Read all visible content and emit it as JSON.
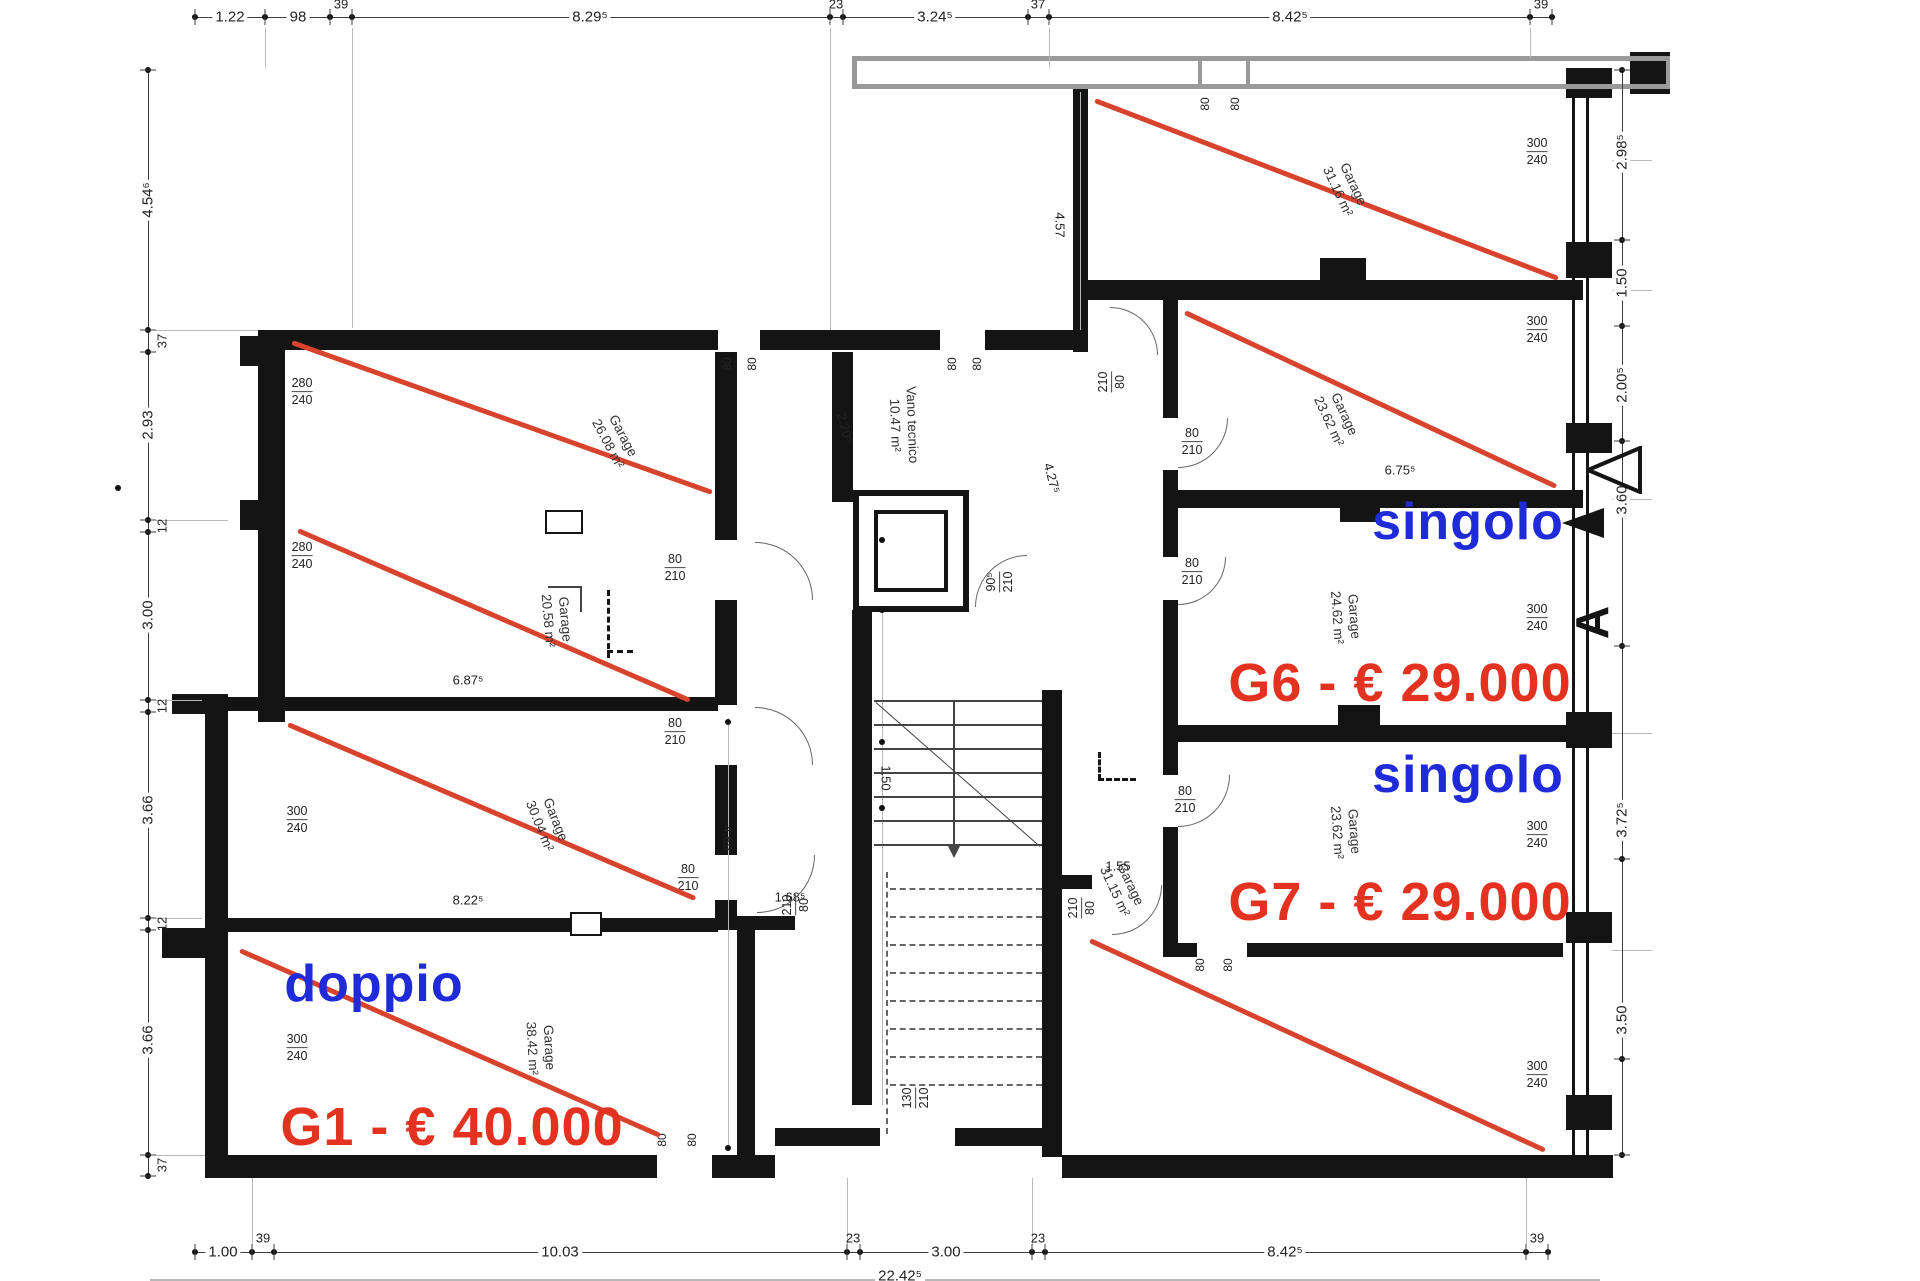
{
  "drawing": {
    "type": "architectural floor plan - garage level with prices",
    "section_letter": "A",
    "palette": {
      "wall": "#141414",
      "gray_wall": "#9a9a9a",
      "red_line": "#d8432d",
      "blue_text": "#1f2bd8",
      "red_text": "#e33220",
      "dim_text": "#222222"
    },
    "sale_labels": [
      {
        "text": "doppio",
        "x": 374,
        "y": 984,
        "color": "#1f2bd8",
        "size": 52
      },
      {
        "text": "G1 - € 40.000",
        "x": 452,
        "y": 1127,
        "color": "#e33220",
        "size": 54
      },
      {
        "text": "singolo",
        "x": 1468,
        "y": 522,
        "color": "#1f2bd8",
        "size": 52
      },
      {
        "text": "G6 - € 29.000",
        "x": 1400,
        "y": 683,
        "color": "#e33220",
        "size": 54
      },
      {
        "text": "singolo",
        "x": 1468,
        "y": 775,
        "color": "#1f2bd8",
        "size": 52
      },
      {
        "text": "G7 - € 29.000",
        "x": 1400,
        "y": 902,
        "color": "#e33220",
        "size": 54
      }
    ],
    "rooms": [
      {
        "name": "Garage",
        "area": "26.08 m²",
        "x": 615,
        "y": 440,
        "rot": 62
      },
      {
        "name": "Garage",
        "area": "20.58 m²",
        "x": 556,
        "y": 620,
        "rot": 85
      },
      {
        "name": "Garage",
        "area": "30.04 m²",
        "x": 547,
        "y": 823,
        "rot": 68
      },
      {
        "name": "Garage",
        "area": "38.42 m²",
        "x": 540,
        "y": 1048,
        "rot": 87
      },
      {
        "name": "Vano tecnico",
        "area": "10.47 m²",
        "x": 903,
        "y": 425,
        "rot": 88
      },
      {
        "name": "Garage",
        "area": "31.16 m²",
        "x": 1345,
        "y": 188,
        "rot": 65
      },
      {
        "name": "Garage",
        "area": "23.62 m²",
        "x": 1336,
        "y": 418,
        "rot": 65
      },
      {
        "name": "Garage",
        "area": "24.62 m²",
        "x": 1345,
        "y": 617,
        "rot": 86
      },
      {
        "name": "Garage",
        "area": "23.62 m²",
        "x": 1345,
        "y": 832,
        "rot": 86
      },
      {
        "name": "Garage",
        "area": "31.15 m²",
        "x": 1122,
        "y": 888,
        "rot": 65
      }
    ],
    "chains": {
      "top": {
        "line": [
          195,
          17,
          1357,
          0
        ],
        "ticks_x": [
          195,
          265,
          330,
          352,
          830,
          843,
          1028,
          1049,
          1530,
          1552
        ],
        "labels": [
          {
            "t": "1.22",
            "x": 230,
            "y": 17
          },
          {
            "t": "98",
            "x": 298,
            "y": 17
          },
          {
            "t": "39",
            "x": 341,
            "y": 4,
            "off": true
          },
          {
            "t": "8.29⁵",
            "x": 590,
            "y": 17
          },
          {
            "t": "23",
            "x": 836,
            "y": 4,
            "off": true
          },
          {
            "t": "3.24⁵",
            "x": 935,
            "y": 17
          },
          {
            "t": "37",
            "x": 1038,
            "y": 4,
            "off": true
          },
          {
            "t": "8.42⁵",
            "x": 1290,
            "y": 17
          },
          {
            "t": "39",
            "x": 1541,
            "y": 4,
            "off": true
          }
        ]
      },
      "bottom": {
        "line": [
          195,
          1252,
          1353,
          0
        ],
        "ticks_x": [
          195,
          252,
          274,
          847,
          860,
          1032,
          1045,
          1526,
          1548
        ],
        "labels": [
          {
            "t": "1.00",
            "x": 223,
            "y": 1252
          },
          {
            "t": "39",
            "x": 263,
            "y": 1238,
            "off": true
          },
          {
            "t": "10.03",
            "x": 560,
            "y": 1252
          },
          {
            "t": "23",
            "x": 853,
            "y": 1238,
            "off": true
          },
          {
            "t": "3.00",
            "x": 946,
            "y": 1252
          },
          {
            "t": "23",
            "x": 1038,
            "y": 1238,
            "off": true
          },
          {
            "t": "8.42⁵",
            "x": 1285,
            "y": 1252
          },
          {
            "t": "39",
            "x": 1537,
            "y": 1238,
            "off": true
          },
          {
            "t": "22.42⁵",
            "x": 900,
            "y": 1276
          }
        ]
      },
      "left": {
        "line": [
          148,
          70,
          0,
          1106
        ],
        "ticks_y": [
          70,
          330,
          352,
          520,
          532,
          700,
          712,
          918,
          930,
          1155,
          1176
        ],
        "labels": [
          {
            "t": "4.54⁶",
            "x": 148,
            "y": 200
          },
          {
            "t": "37",
            "x": 162,
            "y": 341,
            "off": true
          },
          {
            "t": "2.93",
            "x": 148,
            "y": 425
          },
          {
            "t": "12",
            "x": 162,
            "y": 526,
            "off": true
          },
          {
            "t": "3.00",
            "x": 148,
            "y": 615
          },
          {
            "t": "12",
            "x": 162,
            "y": 706,
            "off": true
          },
          {
            "t": "3.66",
            "x": 148,
            "y": 810
          },
          {
            "t": "12",
            "x": 162,
            "y": 924,
            "off": true
          },
          {
            "t": "3.66",
            "x": 148,
            "y": 1040
          },
          {
            "t": "37",
            "x": 162,
            "y": 1165,
            "off": true
          }
        ]
      },
      "right": {
        "line": [
          1622,
          70,
          0,
          1085
        ],
        "ticks_y": [
          70,
          240,
          326,
          441,
          646,
          859,
          1059,
          1155
        ],
        "labels": [
          {
            "t": "2.98⁵",
            "x": 1622,
            "y": 152
          },
          {
            "t": "1.50",
            "x": 1622,
            "y": 283
          },
          {
            "t": "2.00⁵",
            "x": 1622,
            "y": 385
          },
          {
            "t": "3.60",
            "x": 1622,
            "y": 500
          },
          {
            "t": "3.72⁵",
            "x": 1622,
            "y": 820
          },
          {
            "t": "3.50",
            "x": 1622,
            "y": 1020
          }
        ]
      }
    },
    "dims_plain": [
      {
        "t": "6.87⁵",
        "x": 468,
        "y": 680
      },
      {
        "t": "8.22⁵",
        "x": 468,
        "y": 900
      },
      {
        "t": "1.68⁵",
        "x": 790,
        "y": 897
      },
      {
        "t": "1.55",
        "x": 1118,
        "y": 866
      },
      {
        "t": "6.75⁵",
        "x": 1400,
        "y": 470
      }
    ],
    "dims_rot": [
      {
        "t": "2.20⁵",
        "x": 845,
        "y": 428,
        "rot": 75
      },
      {
        "t": "4.27⁵",
        "x": 1052,
        "y": 478,
        "rot": 75
      },
      {
        "t": "4.57",
        "x": 1060,
        "y": 225,
        "rot": 90
      },
      {
        "t": "4.69",
        "x": 728,
        "y": 838,
        "rot": 90
      },
      {
        "t": "1.50",
        "x": 886,
        "y": 570,
        "rot": 90
      },
      {
        "t": "1.50",
        "x": 886,
        "y": 778,
        "rot": 90
      }
    ],
    "door_fracs": [
      {
        "top": "80",
        "bot": "210",
        "x": 675,
        "y": 568
      },
      {
        "top": "80",
        "bot": "210",
        "x": 675,
        "y": 732
      },
      {
        "top": "80",
        "bot": "210",
        "x": 688,
        "y": 878
      },
      {
        "top": "80",
        "bot": "210",
        "x": 1192,
        "y": 442
      },
      {
        "top": "80",
        "bot": "210",
        "x": 1192,
        "y": 572
      },
      {
        "top": "80",
        "bot": "210",
        "x": 1185,
        "y": 800
      }
    ],
    "door_fracs_rot": [
      {
        "top": "210",
        "bot": "80",
        "x": 796,
        "y": 905
      },
      {
        "top": "90⁵",
        "bot": "210",
        "x": 1000,
        "y": 582
      },
      {
        "top": "210",
        "bot": "80",
        "x": 1112,
        "y": 382
      },
      {
        "top": "210",
        "bot": "80",
        "x": 1082,
        "y": 908
      },
      {
        "top": "130",
        "bot": "210",
        "x": 916,
        "y": 1098
      }
    ],
    "garage_door_fracs": [
      {
        "top": "280",
        "bot": "240",
        "x": 302,
        "y": 392
      },
      {
        "top": "280",
        "bot": "240",
        "x": 302,
        "y": 556
      },
      {
        "top": "300",
        "bot": "240",
        "x": 297,
        "y": 820
      },
      {
        "top": "300",
        "bot": "240",
        "x": 297,
        "y": 1048
      },
      {
        "top": "300",
        "bot": "240",
        "x": 1537,
        "y": 152
      },
      {
        "top": "300",
        "bot": "240",
        "x": 1537,
        "y": 330
      },
      {
        "top": "300",
        "bot": "240",
        "x": 1537,
        "y": 618
      },
      {
        "top": "300",
        "bot": "240",
        "x": 1537,
        "y": 835
      },
      {
        "top": "300",
        "bot": "240",
        "x": 1537,
        "y": 1075
      }
    ],
    "opening_labels": [
      {
        "t": "80",
        "x": 727,
        "y": 364
      },
      {
        "t": "80",
        "x": 752,
        "y": 364
      },
      {
        "t": "80",
        "x": 952,
        "y": 364
      },
      {
        "t": "80",
        "x": 977,
        "y": 364
      },
      {
        "t": "80",
        "x": 662,
        "y": 1140
      },
      {
        "t": "80",
        "x": 692,
        "y": 1140
      },
      {
        "t": "80",
        "x": 1200,
        "y": 965
      },
      {
        "t": "80",
        "x": 1228,
        "y": 965
      },
      {
        "t": "80",
        "x": 1205,
        "y": 104
      },
      {
        "t": "80",
        "x": 1235,
        "y": 104
      }
    ],
    "red_lines": [
      [
        292,
        342,
        712,
        492
      ],
      [
        298,
        530,
        690,
        700
      ],
      [
        288,
        724,
        695,
        898
      ],
      [
        240,
        950,
        660,
        1135
      ],
      [
        1095,
        100,
        1558,
        278
      ],
      [
        1185,
        312,
        1556,
        486
      ],
      [
        1090,
        940,
        1545,
        1150
      ]
    ],
    "walls": [
      [
        258,
        330,
        460,
        20
      ],
      [
        760,
        330,
        180,
        20
      ],
      [
        985,
        330,
        103,
        20
      ],
      [
        258,
        330,
        27,
        392
      ],
      [
        240,
        336,
        18,
        30
      ],
      [
        240,
        500,
        18,
        30
      ],
      [
        172,
        694,
        56,
        20
      ],
      [
        228,
        697,
        490,
        14
      ],
      [
        205,
        714,
        23,
        443
      ],
      [
        162,
        928,
        66,
        30
      ],
      [
        228,
        918,
        490,
        14
      ],
      [
        205,
        1155,
        452,
        23
      ],
      [
        712,
        1155,
        63,
        23
      ],
      [
        715,
        352,
        22,
        188
      ],
      [
        715,
        600,
        22,
        105
      ],
      [
        715,
        765,
        22,
        90
      ],
      [
        715,
        900,
        22,
        30
      ],
      [
        737,
        916,
        58,
        14
      ],
      [
        737,
        930,
        18,
        228
      ],
      [
        775,
        1128,
        105,
        18
      ],
      [
        955,
        1128,
        107,
        18
      ],
      [
        832,
        352,
        21,
        150
      ],
      [
        852,
        610,
        20,
        95
      ],
      [
        852,
        700,
        20,
        405
      ],
      [
        1042,
        690,
        20,
        467
      ],
      [
        1062,
        875,
        30,
        14
      ],
      [
        1073,
        88,
        15,
        264
      ],
      [
        1163,
        300,
        15,
        118
      ],
      [
        1163,
        470,
        15,
        87
      ],
      [
        1163,
        600,
        15,
        175
      ],
      [
        1163,
        827,
        15,
        130
      ],
      [
        1088,
        280,
        495,
        20
      ],
      [
        1320,
        258,
        46,
        22
      ],
      [
        1178,
        490,
        405,
        18
      ],
      [
        1340,
        508,
        40,
        14
      ],
      [
        1178,
        725,
        405,
        17
      ],
      [
        1338,
        705,
        42,
        20
      ],
      [
        1167,
        943,
        30,
        14
      ],
      [
        1247,
        943,
        316,
        14
      ],
      [
        1062,
        1155,
        521,
        23
      ],
      [
        1566,
        68,
        46,
        30
      ],
      [
        1566,
        242,
        46,
        36
      ],
      [
        1566,
        423,
        46,
        30
      ],
      [
        1566,
        712,
        46,
        36
      ],
      [
        1566,
        912,
        46,
        31
      ],
      [
        1566,
        1095,
        46,
        35
      ],
      [
        1563,
        1155,
        50,
        23
      ],
      [
        1630,
        52,
        40,
        42
      ]
    ],
    "thin_walls": [
      [
        1572,
        68,
        3,
        1087
      ],
      [
        1586,
        68,
        3,
        1087
      ]
    ],
    "gray_walls": [
      [
        855,
        56,
        815,
        5
      ],
      [
        855,
        84,
        815,
        5
      ],
      [
        852,
        56,
        5,
        33
      ],
      [
        1198,
        56,
        4,
        33
      ],
      [
        1246,
        56,
        4,
        33
      ],
      [
        1666,
        56,
        4,
        33
      ]
    ],
    "white_notches": [
      [
        545,
        510,
        38,
        24
      ],
      [
        570,
        912,
        32,
        24
      ]
    ],
    "witness_lines": [
      [
        352,
        28,
        1,
        300
      ],
      [
        830,
        28,
        1,
        302
      ],
      [
        1049,
        28,
        1,
        40
      ],
      [
        265,
        28,
        1,
        40
      ],
      [
        1530,
        28,
        1,
        30
      ],
      [
        156,
        330,
        102,
        1
      ],
      [
        156,
        520,
        72,
        1
      ],
      [
        156,
        700,
        46,
        1
      ],
      [
        156,
        918,
        46,
        1
      ],
      [
        156,
        1155,
        49,
        1
      ],
      [
        1612,
        290,
        40,
        1
      ],
      [
        1612,
        499,
        40,
        1
      ],
      [
        1612,
        733,
        40,
        1
      ],
      [
        1612,
        950,
        40,
        1
      ],
      [
        1612,
        160,
        40,
        1
      ],
      [
        252,
        1178,
        1,
        66
      ],
      [
        847,
        1178,
        1,
        66
      ],
      [
        1032,
        1178,
        1,
        66
      ],
      [
        1526,
        1178,
        1,
        66
      ],
      [
        882,
        505,
        1,
        600
      ],
      [
        728,
        718,
        1,
        432
      ],
      [
        1080,
        92,
        1,
        238
      ],
      [
        150,
        1279,
        1450,
        2
      ]
    ],
    "inner_dots": [
      [
        882,
        540
      ],
      [
        882,
        610
      ],
      [
        882,
        742
      ],
      [
        882,
        808
      ],
      [
        728,
        722
      ],
      [
        728,
        1148
      ],
      [
        118,
        488
      ]
    ],
    "arcs": [
      {
        "cx": 755,
        "cy": 600,
        "r": 58,
        "dir": "ne"
      },
      {
        "cx": 755,
        "cy": 765,
        "r": 58,
        "dir": "ne"
      },
      {
        "cx": 757,
        "cy": 855,
        "r": 58,
        "dir": "se"
      },
      {
        "cx": 1027,
        "cy": 607,
        "r": 52,
        "dir": "nw"
      },
      {
        "cx": 1110,
        "cy": 355,
        "r": 48,
        "dir": "ne"
      },
      {
        "cx": 1178,
        "cy": 418,
        "r": 50,
        "dir": "se"
      },
      {
        "cx": 1178,
        "cy": 557,
        "r": 48,
        "dir": "se"
      },
      {
        "cx": 1178,
        "cy": 775,
        "r": 52,
        "dir": "se"
      },
      {
        "cx": 1112,
        "cy": 885,
        "r": 50,
        "dir": "se"
      }
    ],
    "dashes": [
      {
        "x": 1098,
        "y": 778,
        "len": 38,
        "dir": "h"
      },
      {
        "x": 1098,
        "y": 752,
        "len": 28,
        "dir": "v"
      },
      {
        "x": 607,
        "y": 590,
        "len": 68,
        "dir": "v"
      },
      {
        "x": 607,
        "y": 650,
        "len": 26,
        "dir": "h"
      }
    ],
    "solid_marks": [
      [
        548,
        586,
        34,
        2
      ],
      [
        580,
        586,
        2,
        26
      ]
    ],
    "stairs": {
      "x": 874,
      "w": 168,
      "solid_y0": 700,
      "solid_step": 24,
      "solid_count": 7,
      "diag": [
        876,
        702,
        1040,
        846
      ],
      "arrow_x": 953,
      "arrow_y0": 702,
      "arrow_y1": 846,
      "dashed_x": 890,
      "dashed_w": 152,
      "dashed_y0": 888,
      "dashed_step": 28,
      "dashed_count": 8,
      "dashed_vert": {
        "x": 886,
        "y0": 872,
        "y1": 1134
      }
    },
    "elevator": {
      "outer": [
        853,
        490,
        116,
        122
      ],
      "inner": [
        874,
        510,
        74,
        82
      ]
    }
  }
}
